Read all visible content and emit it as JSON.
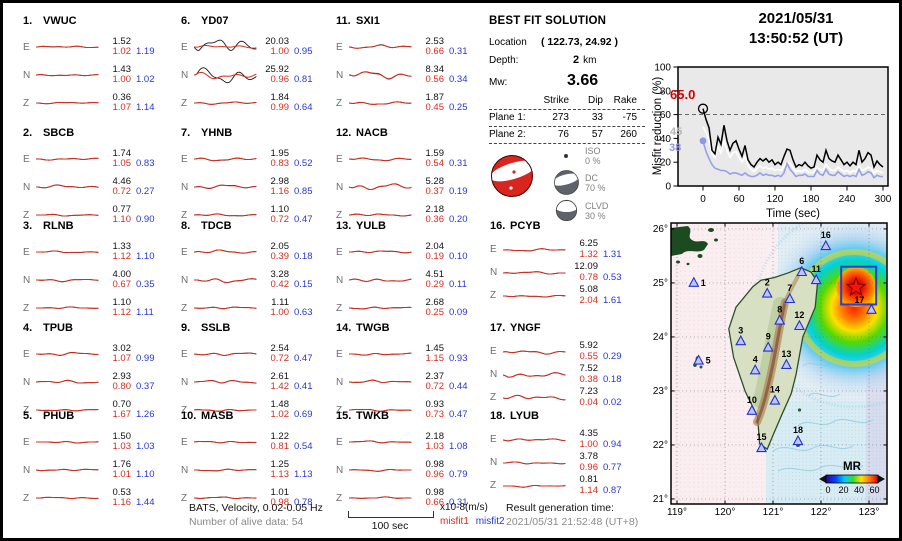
{
  "header": {
    "date": "2021/05/31",
    "time": "13:50:52  (UT)"
  },
  "stations": [
    {
      "num": "1.",
      "name": "VWUC",
      "comps": [
        {
          "c": "E",
          "amp": "1.52",
          "m1": "1.02",
          "m2": "1.19",
          "tb": 1.2,
          "tr": 1.1
        },
        {
          "c": "N",
          "amp": "1.43",
          "m1": "1.00",
          "m2": "1.02",
          "tb": 1.2,
          "tr": 1.1
        },
        {
          "c": "Z",
          "amp": "0.36",
          "m1": "1.07",
          "m2": "1.14",
          "tb": 1.0,
          "tr": 1.0
        }
      ]
    },
    {
      "num": "2.",
      "name": "SBCB",
      "comps": [
        {
          "c": "E",
          "amp": "1.74",
          "m1": "1.05",
          "m2": "0.83",
          "tb": 1.4,
          "tr": 1.3
        },
        {
          "c": "N",
          "amp": "4.46",
          "m1": "0.72",
          "m2": "0.27",
          "tb": 2.2,
          "tr": 2.0
        },
        {
          "c": "Z",
          "amp": "0.77",
          "m1": "1.10",
          "m2": "0.90",
          "tb": 1.1,
          "tr": 1.0
        }
      ]
    },
    {
      "num": "3.",
      "name": "RLNB",
      "comps": [
        {
          "c": "E",
          "amp": "1.33",
          "m1": "1.12",
          "m2": "1.10",
          "tb": 1.2,
          "tr": 1.1
        },
        {
          "c": "N",
          "amp": "4.00",
          "m1": "0.67",
          "m2": "0.35",
          "tb": 1.6,
          "tr": 1.5
        },
        {
          "c": "Z",
          "amp": "1.10",
          "m1": "1.12",
          "m2": "1.11",
          "tb": 1.1,
          "tr": 1.0
        }
      ]
    },
    {
      "num": "4.",
      "name": "TPUB",
      "comps": [
        {
          "c": "E",
          "amp": "3.02",
          "m1": "1.07",
          "m2": "0.99",
          "tb": 1.9,
          "tr": 1.7
        },
        {
          "c": "N",
          "amp": "2.93",
          "m1": "0.80",
          "m2": "0.37",
          "tb": 2.1,
          "tr": 1.9
        },
        {
          "c": "Z",
          "amp": "0.70",
          "m1": "1.67",
          "m2": "1.26",
          "tb": 1.2,
          "tr": 1.1
        }
      ]
    },
    {
      "num": "5.",
      "name": "PHUB",
      "comps": [
        {
          "c": "E",
          "amp": "1.50",
          "m1": "1.03",
          "m2": "1.03",
          "tb": 1.2,
          "tr": 1.1
        },
        {
          "c": "N",
          "amp": "1.76",
          "m1": "1.01",
          "m2": "1.10",
          "tb": 1.3,
          "tr": 1.2
        },
        {
          "c": "Z",
          "amp": "0.53",
          "m1": "1.16",
          "m2": "1.44",
          "tb": 1.0,
          "tr": 1.0
        }
      ]
    },
    {
      "num": "6.",
      "name": "YD07",
      "comps": [
        {
          "c": "E",
          "amp": "20.03",
          "m1": "1.00",
          "m2": "0.95",
          "tb": 11,
          "tr": 2.2
        },
        {
          "c": "N",
          "amp": "25.92",
          "m1": "0.96",
          "m2": "0.81",
          "tb": 11,
          "tr": 4.8
        },
        {
          "c": "Z",
          "amp": "1.84",
          "m1": "0.99",
          "m2": "0.64",
          "tb": 1.6,
          "tr": 1.6
        }
      ]
    },
    {
      "num": "7.",
      "name": "YHNB",
      "comps": [
        {
          "c": "E",
          "amp": "1.95",
          "m1": "0.83",
          "m2": "0.52",
          "tb": 2.2,
          "tr": 2.0
        },
        {
          "c": "N",
          "amp": "2.98",
          "m1": "1.16",
          "m2": "0.85",
          "tb": 2.6,
          "tr": 2.3
        },
        {
          "c": "Z",
          "amp": "1.10",
          "m1": "0.72",
          "m2": "0.47",
          "tb": 1.5,
          "tr": 1.4
        }
      ]
    },
    {
      "num": "8.",
      "name": "TDCB",
      "comps": [
        {
          "c": "E",
          "amp": "2.05",
          "m1": "0.39",
          "m2": "0.18",
          "tb": 2.2,
          "tr": 2.1
        },
        {
          "c": "N",
          "amp": "3.28",
          "m1": "0.42",
          "m2": "0.15",
          "tb": 3.0,
          "tr": 2.8
        },
        {
          "c": "Z",
          "amp": "1.11",
          "m1": "1.00",
          "m2": "0.63",
          "tb": 1.4,
          "tr": 1.3
        }
      ]
    },
    {
      "num": "9.",
      "name": "SSLB",
      "comps": [
        {
          "c": "E",
          "amp": "2.54",
          "m1": "0.72",
          "m2": "0.47",
          "tb": 1.9,
          "tr": 1.8
        },
        {
          "c": "N",
          "amp": "2.61",
          "m1": "1.42",
          "m2": "0.41",
          "tb": 2.4,
          "tr": 2.2
        },
        {
          "c": "Z",
          "amp": "1.48",
          "m1": "1.02",
          "m2": "0.69",
          "tb": 1.5,
          "tr": 1.4
        }
      ]
    },
    {
      "num": "10.",
      "name": "MASB",
      "comps": [
        {
          "c": "E",
          "amp": "1.22",
          "m1": "0.81",
          "m2": "0.54",
          "tb": 1.3,
          "tr": 1.2
        },
        {
          "c": "N",
          "amp": "1.25",
          "m1": "1.13",
          "m2": "1.13",
          "tb": 1.3,
          "tr": 1.2
        },
        {
          "c": "Z",
          "amp": "1.01",
          "m1": "0.98",
          "m2": "0.78",
          "tb": 1.1,
          "tr": 1.0
        }
      ]
    },
    {
      "num": "11.",
      "name": "SXI1",
      "comps": [
        {
          "c": "E",
          "amp": "2.53",
          "m1": "0.66",
          "m2": "0.31",
          "tb": 2.4,
          "tr": 2.2
        },
        {
          "c": "N",
          "amp": "8.34",
          "m1": "0.56",
          "m2": "0.34",
          "tb": 5.0,
          "tr": 4.6
        },
        {
          "c": "Z",
          "amp": "1.87",
          "m1": "0.45",
          "m2": "0.25",
          "tb": 2.0,
          "tr": 1.9
        }
      ]
    },
    {
      "num": "12.",
      "name": "NACB",
      "comps": [
        {
          "c": "E",
          "amp": "1.59",
          "m1": "0.54",
          "m2": "0.31",
          "tb": 2.0,
          "tr": 1.9
        },
        {
          "c": "N",
          "amp": "5.28",
          "m1": "0.37",
          "m2": "0.19",
          "tb": 4.4,
          "tr": 4.2
        },
        {
          "c": "Z",
          "amp": "2.18",
          "m1": "0.36",
          "m2": "0.20",
          "tb": 1.6,
          "tr": 1.5
        }
      ]
    },
    {
      "num": "13.",
      "name": "YULB",
      "comps": [
        {
          "c": "E",
          "amp": "2.04",
          "m1": "0.19",
          "m2": "0.10",
          "tb": 1.6,
          "tr": 1.5
        },
        {
          "c": "N",
          "amp": "4.51",
          "m1": "0.29",
          "m2": "0.11",
          "tb": 2.4,
          "tr": 2.3
        },
        {
          "c": "Z",
          "amp": "2.68",
          "m1": "0.25",
          "m2": "0.09",
          "tb": 1.4,
          "tr": 1.3
        }
      ]
    },
    {
      "num": "14.",
      "name": "TWGB",
      "comps": [
        {
          "c": "E",
          "amp": "1.45",
          "m1": "1.15",
          "m2": "0.93",
          "tb": 1.5,
          "tr": 1.4
        },
        {
          "c": "N",
          "amp": "2.37",
          "m1": "0.72",
          "m2": "0.44",
          "tb": 1.9,
          "tr": 1.8
        },
        {
          "c": "Z",
          "amp": "0.93",
          "m1": "0.73",
          "m2": "0.47",
          "tb": 1.3,
          "tr": 1.2
        }
      ]
    },
    {
      "num": "15.",
      "name": "TWKB",
      "comps": [
        {
          "c": "E",
          "amp": "2.18",
          "m1": "1.03",
          "m2": "1.08",
          "tb": 1.3,
          "tr": 1.2
        },
        {
          "c": "N",
          "amp": "0.98",
          "m1": "0.96",
          "m2": "0.79",
          "tb": 1.2,
          "tr": 1.1
        },
        {
          "c": "Z",
          "amp": "0.98",
          "m1": "0.66",
          "m2": "0.31",
          "tb": 1.1,
          "tr": 1.0
        }
      ]
    },
    {
      "num": "16.",
      "name": "PCYB",
      "comps": [
        {
          "c": "E",
          "amp": "6.25",
          "m1": "1.32",
          "m2": "1.31",
          "tb": 1.5,
          "tr": 1.4
        },
        {
          "c": "N",
          "amp": "12.09",
          "m1": "0.78",
          "m2": "0.53",
          "tb": 1.7,
          "tr": 1.6
        },
        {
          "c": "Z",
          "amp": "5.08",
          "m1": "2.04",
          "m2": "1.61",
          "tb": 1.3,
          "tr": 1.2
        }
      ]
    },
    {
      "num": "17.",
      "name": "YNGF",
      "comps": [
        {
          "c": "E",
          "amp": "5.92",
          "m1": "0.55",
          "m2": "0.29",
          "tb": 2.6,
          "tr": 2.5
        },
        {
          "c": "N",
          "amp": "7.52",
          "m1": "0.38",
          "m2": "0.18",
          "tb": 3.6,
          "tr": 3.5
        },
        {
          "c": "Z",
          "amp": "7.23",
          "m1": "0.04",
          "m2": "0.02",
          "tb": 3.4,
          "tr": 3.3
        }
      ]
    },
    {
      "num": "18.",
      "name": "LYUB",
      "comps": [
        {
          "c": "E",
          "amp": "4.35",
          "m1": "1.00",
          "m2": "0.94",
          "tb": 1.9,
          "tr": 1.8
        },
        {
          "c": "N",
          "amp": "3.78",
          "m1": "0.96",
          "m2": "0.77",
          "tb": 1.5,
          "tr": 1.4
        },
        {
          "c": "Z",
          "amp": "0.81",
          "m1": "1.14",
          "m2": "0.87",
          "tb": 1.2,
          "tr": 1.1
        }
      ]
    }
  ],
  "solution": {
    "title": "BEST FIT SOLUTION",
    "location_label": "Location",
    "location_value": "( 122.73, 24.92 )",
    "depth_label": "Depth:",
    "depth_value": "2",
    "depth_unit": "km",
    "mw_label": "Mw:",
    "mw_value": "3.66",
    "table": {
      "headers": [
        "Strike",
        "Dip",
        "Rake"
      ],
      "rows": [
        {
          "label": "Plane 1:",
          "strike": "273",
          "dip": "33",
          "rake": "-75"
        },
        {
          "label": "Plane 2:",
          "strike": "76",
          "dip": "57",
          "rake": "260"
        }
      ]
    },
    "decomp": [
      {
        "name": "ISO",
        "pct": "0 %"
      },
      {
        "name": "DC",
        "pct": "70 %"
      },
      {
        "name": "CLVD",
        "pct": "30 %"
      }
    ]
  },
  "chart_data": {
    "type": "line",
    "title": "Misfit reduction vs time",
    "xlabel": "Time (sec)",
    "ylabel": "Misfit reduction (%)",
    "xlim": [
      0,
      300
    ],
    "ylim": [
      0,
      100
    ],
    "xticks": [
      0,
      60,
      120,
      180,
      240,
      300
    ],
    "yticks": [
      0,
      20,
      40,
      60,
      80,
      100
    ],
    "x_step": 5,
    "dashed_ref": 60,
    "series": [
      {
        "name": "white",
        "color": "#ffffff",
        "values": [
          50,
          45,
          39,
          27,
          24,
          33,
          28,
          38,
          30,
          24,
          28,
          29,
          24,
          20,
          25,
          17,
          14,
          12,
          15,
          17,
          15,
          16,
          14,
          15,
          13,
          14,
          13,
          17,
          20,
          19,
          15,
          12,
          13,
          12,
          14,
          12,
          11,
          12,
          16,
          14,
          13,
          18,
          15,
          13,
          13,
          16,
          14,
          12,
          13,
          11,
          13,
          12,
          17,
          13,
          14,
          16,
          15,
          11,
          13,
          12,
          11
        ]
      },
      {
        "name": "blue",
        "color": "#97a0e8",
        "values": [
          38,
          29,
          23,
          18,
          15,
          14,
          13,
          13,
          12,
          10,
          11,
          11,
          10,
          9,
          11,
          9,
          8,
          8,
          9,
          11,
          9,
          10,
          9,
          9,
          8,
          9,
          8,
          11,
          19,
          14,
          11,
          8,
          9,
          9,
          10,
          8,
          8,
          8,
          13,
          10,
          9,
          14,
          10,
          9,
          9,
          12,
          10,
          8,
          9,
          8,
          9,
          8,
          14,
          9,
          10,
          12,
          11,
          7,
          9,
          8,
          8
        ]
      },
      {
        "name": "black",
        "color": "#000000",
        "values": [
          65,
          56,
          49,
          30,
          27,
          41,
          35,
          51,
          38,
          30,
          36,
          38,
          31,
          25,
          34,
          22,
          18,
          16,
          20,
          23,
          21,
          23,
          20,
          22,
          18,
          20,
          18,
          25,
          31,
          30,
          22,
          16,
          18,
          17,
          20,
          17,
          15,
          16,
          26,
          22,
          20,
          30,
          23,
          21,
          20,
          26,
          22,
          18,
          20,
          17,
          20,
          18,
          30,
          20,
          23,
          28,
          26,
          16,
          21,
          18,
          16
        ]
      }
    ],
    "start_labels": [
      {
        "text": "65.0",
        "color": "#d40000"
      },
      {
        "text": "45",
        "color": "#b5b5b5"
      },
      {
        "text": "38",
        "color": "#8e97e6"
      }
    ]
  },
  "map": {
    "lat_ticks": [
      "26°",
      "25°",
      "24°",
      "23°",
      "22°",
      "21°"
    ],
    "lat_vals": [
      26,
      25,
      24,
      23,
      22,
      21
    ],
    "lon_ticks": [
      "119°",
      "120°",
      "121°",
      "122°",
      "123°"
    ],
    "lon_vals": [
      119,
      120,
      121,
      122,
      123
    ],
    "star": {
      "lon": 122.73,
      "lat": 24.92
    },
    "box": {
      "lon1": 122.42,
      "lat1": 25.3,
      "lon2": 123.15,
      "lat2": 24.6
    },
    "stations": [
      {
        "id": "1",
        "lon": 119.35,
        "lat": 25.0,
        "lp": "r"
      },
      {
        "id": "2",
        "lon": 120.88,
        "lat": 24.8,
        "lp": "t"
      },
      {
        "id": "3",
        "lon": 120.33,
        "lat": 23.92,
        "lp": "t"
      },
      {
        "id": "4",
        "lon": 120.63,
        "lat": 23.38,
        "lp": "t"
      },
      {
        "id": "5",
        "lon": 119.45,
        "lat": 23.56,
        "lp": "r"
      },
      {
        "id": "6",
        "lon": 121.6,
        "lat": 25.2,
        "lp": "t"
      },
      {
        "id": "7",
        "lon": 121.35,
        "lat": 24.7,
        "lp": "t"
      },
      {
        "id": "8",
        "lon": 121.14,
        "lat": 24.3,
        "lp": "t"
      },
      {
        "id": "9",
        "lon": 120.9,
        "lat": 23.8,
        "lp": "t"
      },
      {
        "id": "10",
        "lon": 120.56,
        "lat": 22.63,
        "lp": "t"
      },
      {
        "id": "11",
        "lon": 121.9,
        "lat": 25.05,
        "lp": "t"
      },
      {
        "id": "12",
        "lon": 121.55,
        "lat": 24.2,
        "lp": "t"
      },
      {
        "id": "13",
        "lon": 121.28,
        "lat": 23.48,
        "lp": "t"
      },
      {
        "id": "14",
        "lon": 121.04,
        "lat": 22.82,
        "lp": "t"
      },
      {
        "id": "15",
        "lon": 120.76,
        "lat": 21.94,
        "lp": "t"
      },
      {
        "id": "16",
        "lon": 122.1,
        "lat": 25.68,
        "lp": "t"
      },
      {
        "id": "17",
        "lon": 123.05,
        "lat": 24.5,
        "lp": "tl"
      },
      {
        "id": "18",
        "lon": 121.52,
        "lat": 22.07,
        "lp": "t"
      }
    ],
    "colorbar": {
      "label": "MR",
      "ticks": [
        "0",
        "20",
        "40",
        "60"
      ]
    }
  },
  "footer": {
    "filter_line": "BATS, Velocity, 0.02-0.05 Hz",
    "alive_line": "Number of alive data: 54",
    "scale_label": "100 sec",
    "units_label": "x10-8(m/s)",
    "misfit1_label": "misfit1",
    "misfit2_label": "misfit2",
    "result_label": "Result generation time:",
    "result_time": "2021/05/31 21:52:48 (UT+8)"
  }
}
